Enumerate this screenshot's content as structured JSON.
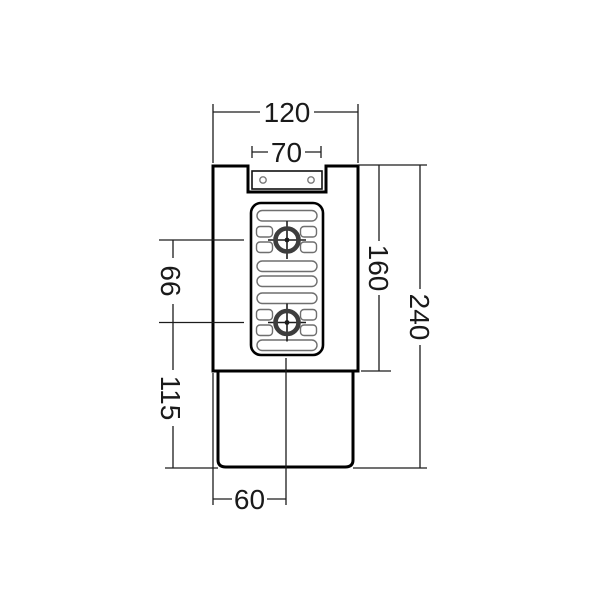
{
  "drawing": {
    "type": "technical-dimension-drawing",
    "view": "front-elevation-drain-body"
  },
  "dimensions": {
    "overall_width": "120",
    "inlet_width": "70",
    "screw_spacing": "66",
    "outlet_section_height": "115",
    "body_height": "160",
    "overall_height": "240",
    "outlet_center_offset": "60"
  },
  "colors": {
    "background": "#ffffff",
    "outline": "#000000",
    "dimension_line": "#1c1c1c",
    "slot_outline": "#6f6f6f",
    "crosshair_ring": "#3d3d3d",
    "hole_outline": "#7a7a7a"
  }
}
